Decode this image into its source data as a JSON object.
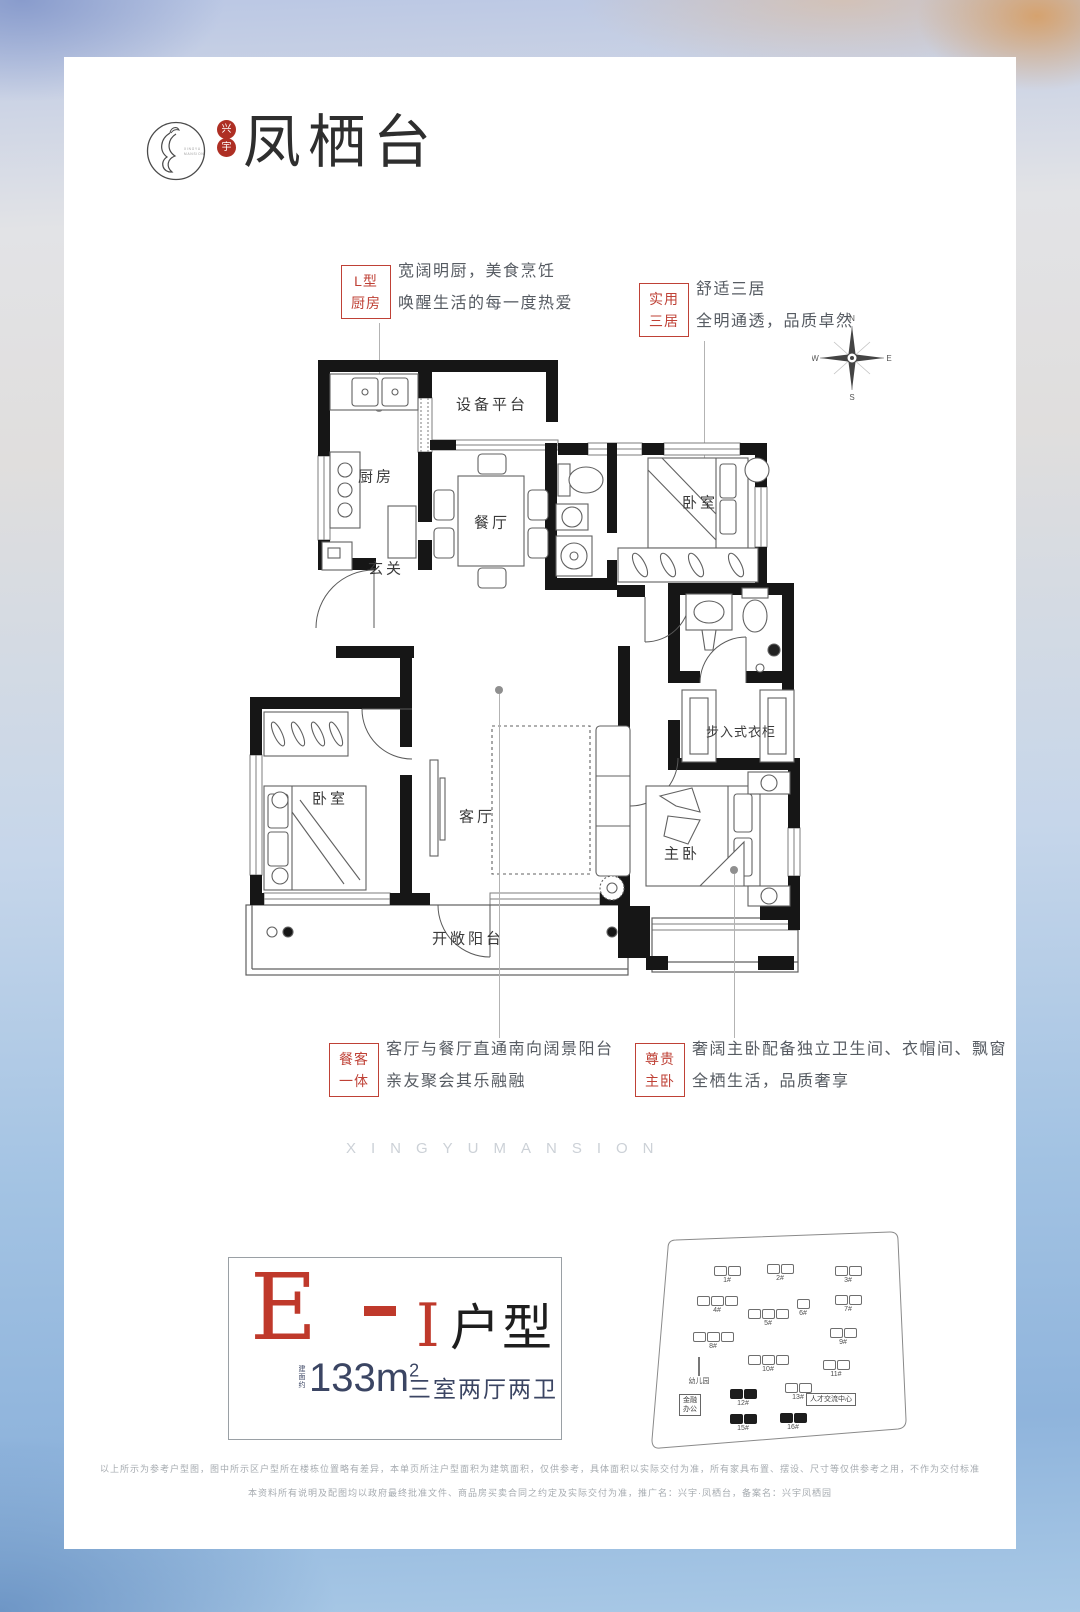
{
  "brand": {
    "name": "凤栖台",
    "seal_top": "兴",
    "seal_bottom": "宇",
    "circle_text_1": "XINGYU",
    "circle_text_2": "MANSION"
  },
  "compass": {
    "n": "N",
    "e": "E",
    "s": "S",
    "w": "W"
  },
  "callouts": {
    "kitchen": {
      "tag1": "L型",
      "tag2": "厨房",
      "line1": "宽阔明厨，美食烹饪",
      "line2": "唤醒生活的每一度热爱"
    },
    "three_bedrooms": {
      "tag1": "实用",
      "tag2": "三居",
      "line1": "舒适三居",
      "line2": "全明通透，品质卓然"
    },
    "dining_living": {
      "tag1": "餐客",
      "tag2": "一体",
      "line1": "客厅与餐厅直通南向阔景阳台",
      "line2": "亲友聚会其乐融融"
    },
    "master_bedroom": {
      "tag1": "尊贵",
      "tag2": "主卧",
      "line1": "奢阔主卧配备独立卫生间、衣帽间、飘窗",
      "line2": "全栖生活，品质奢享"
    }
  },
  "floor_plan": {
    "rooms": {
      "kitchen": "厨房",
      "equipment_platform": "设备平台",
      "dining": "餐厅",
      "foyer": "玄关",
      "bedroom_right": "卧室",
      "bedroom_left": "卧室",
      "living": "客厅",
      "master": "主卧",
      "walk_in_closet": "步入式衣柜",
      "balcony": "开敞阳台"
    }
  },
  "watermark": "XINGYUMANSION",
  "unit_info": {
    "model": "E",
    "variant": "I",
    "type_label": "户型",
    "area_prefix": "建面约",
    "area_value": "133m",
    "area_sup": "2",
    "layout_desc": "三室两厅两卫"
  },
  "site_plan": {
    "buildings": [
      {
        "label": "1#"
      },
      {
        "label": "2#"
      },
      {
        "label": "3#"
      },
      {
        "label": "4#"
      },
      {
        "label": "5#"
      },
      {
        "label": "6#"
      },
      {
        "label": "7#"
      },
      {
        "label": "8#"
      },
      {
        "label": "9#"
      },
      {
        "label": "10#"
      },
      {
        "label": "11#"
      },
      {
        "label": "12#"
      },
      {
        "label": "13#"
      },
      {
        "label": "15#"
      },
      {
        "label": "16#"
      }
    ],
    "facilities": {
      "kindergarten": "幼儿园",
      "finance_office_1": "金融",
      "finance_office_2": "办公",
      "talent_center": "人才交流中心"
    }
  },
  "disclaimer": {
    "line1": "以上所示为参考户型图，图中所示区户型所在楼栋位置略有差异，本单页所注户型面积为建筑面积，仅供参考，具体面积以实际交付为准，所有家具布置、摆设、尺寸等仅供参考之用，不作为交付标准",
    "line2": "本资料所有说明及配图均以政府最终批准文件、商品房买卖合同之约定及实际交付为准，推广名：兴宇·凤栖台，备案名：兴宇凤栖园"
  }
}
